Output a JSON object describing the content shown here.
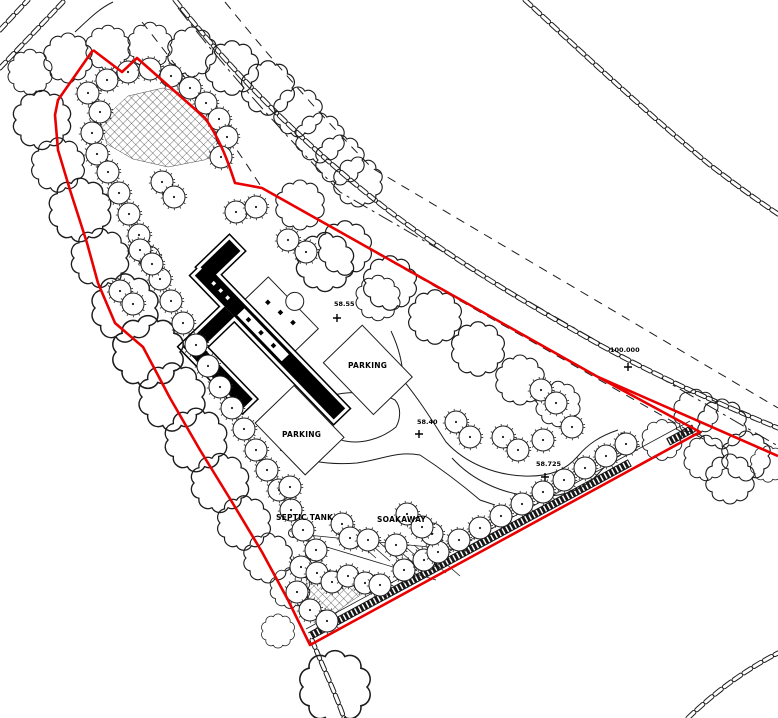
{
  "drawing_title": "Proposed site plan",
  "labels": {
    "parking_upper": "PARKING",
    "parking_lower": "PARKING",
    "septic_tank": "SEPTIC TANK",
    "soakaway": "SOAKAWAY"
  },
  "spot_levels": [
    {
      "name": "spot-level-1",
      "value": "58.55"
    },
    {
      "name": "spot-level-2",
      "value": "58.40"
    },
    {
      "name": "spot-level-3",
      "value": "58.725"
    },
    {
      "name": "spot-level-4",
      "value": "100.000"
    }
  ],
  "colors": {
    "boundary_red": "#e90000",
    "line_black": "#1c1c1c"
  },
  "legend_semantics": {
    "red_line": "site boundary",
    "chain_line": "hedgerow",
    "scalloped_circle": "existing tree canopy",
    "small_circle_dot": "proposed tree",
    "crosshatch": "planting bed",
    "dark_strip": "new hedge bank"
  },
  "site_plan": {
    "trees_small": [
      [
        88,
        93
      ],
      [
        107,
        80
      ],
      [
        128,
        72
      ],
      [
        150,
        69
      ],
      [
        171,
        76
      ],
      [
        190,
        88
      ],
      [
        206,
        103
      ],
      [
        219,
        119
      ],
      [
        227,
        137
      ],
      [
        221,
        157
      ],
      [
        100,
        112
      ],
      [
        92,
        133
      ],
      [
        97,
        154
      ],
      [
        108,
        172
      ],
      [
        119,
        193
      ],
      [
        129,
        214
      ],
      [
        139,
        235
      ],
      [
        149,
        257
      ],
      [
        160,
        279
      ],
      [
        171,
        301
      ],
      [
        183,
        323
      ],
      [
        196,
        345
      ],
      [
        208,
        366
      ],
      [
        220,
        387
      ],
      [
        232,
        408
      ],
      [
        244,
        429
      ],
      [
        256,
        450
      ],
      [
        267,
        470
      ],
      [
        279,
        490
      ],
      [
        291,
        510
      ],
      [
        303,
        530
      ],
      [
        316,
        550
      ],
      [
        301,
        567
      ],
      [
        297,
        592
      ],
      [
        310,
        610
      ],
      [
        327,
        621
      ],
      [
        317,
        573
      ],
      [
        332,
        582
      ],
      [
        348,
        576
      ],
      [
        365,
        583
      ],
      [
        380,
        585
      ],
      [
        404,
        570
      ],
      [
        424,
        560
      ],
      [
        438,
        552
      ],
      [
        459,
        540
      ],
      [
        480,
        528
      ],
      [
        501,
        516
      ],
      [
        522,
        504
      ],
      [
        543,
        492
      ],
      [
        564,
        480
      ],
      [
        585,
        468
      ],
      [
        606,
        456
      ],
      [
        626,
        444
      ],
      [
        236,
        212
      ],
      [
        256,
        207
      ],
      [
        162,
        182
      ],
      [
        174,
        197
      ],
      [
        140,
        250
      ],
      [
        152,
        264
      ],
      [
        120,
        291
      ],
      [
        133,
        304
      ],
      [
        306,
        252
      ],
      [
        288,
        240
      ],
      [
        456,
        422
      ],
      [
        470,
        437
      ],
      [
        503,
        437
      ],
      [
        518,
        450
      ],
      [
        541,
        390
      ],
      [
        556,
        403
      ],
      [
        543,
        440
      ],
      [
        572,
        427
      ],
      [
        342,
        524
      ],
      [
        350,
        538
      ],
      [
        368,
        540
      ],
      [
        396,
        545
      ],
      [
        432,
        534
      ],
      [
        290,
        487
      ],
      [
        407,
        514
      ],
      [
        422,
        527
      ]
    ],
    "trees_large": [
      [
        42,
        120,
        26
      ],
      [
        58,
        165,
        24
      ],
      [
        80,
        210,
        28
      ],
      [
        100,
        258,
        26
      ],
      [
        125,
        308,
        30
      ],
      [
        148,
        352,
        32
      ],
      [
        172,
        397,
        30
      ],
      [
        196,
        440,
        28
      ],
      [
        220,
        483,
        26
      ],
      [
        244,
        523,
        24
      ],
      [
        268,
        558,
        22
      ],
      [
        290,
        588,
        18
      ],
      [
        30,
        72,
        20
      ],
      [
        68,
        58,
        22
      ],
      [
        108,
        48,
        20
      ],
      [
        150,
        45,
        20
      ],
      [
        192,
        52,
        22
      ],
      [
        232,
        68,
        24
      ],
      [
        268,
        88,
        24
      ],
      [
        298,
        112,
        22
      ],
      [
        320,
        138,
        22
      ],
      [
        340,
        160,
        22
      ],
      [
        358,
        182,
        22
      ],
      [
        300,
        205,
        22
      ],
      [
        345,
        248,
        24
      ],
      [
        390,
        283,
        24
      ],
      [
        435,
        317,
        24
      ],
      [
        478,
        349,
        24
      ],
      [
        520,
        380,
        22
      ],
      [
        558,
        404,
        20
      ],
      [
        325,
        262,
        26
      ],
      [
        378,
        298,
        20
      ],
      [
        662,
        440,
        18
      ],
      [
        696,
        412,
        20
      ],
      [
        722,
        424,
        22
      ],
      [
        746,
        456,
        22
      ],
      [
        768,
        464,
        16
      ],
      [
        706,
        458,
        20
      ],
      [
        730,
        479,
        22
      ],
      [
        335,
        687,
        32
      ],
      [
        278,
        631,
        15
      ]
    ]
  }
}
